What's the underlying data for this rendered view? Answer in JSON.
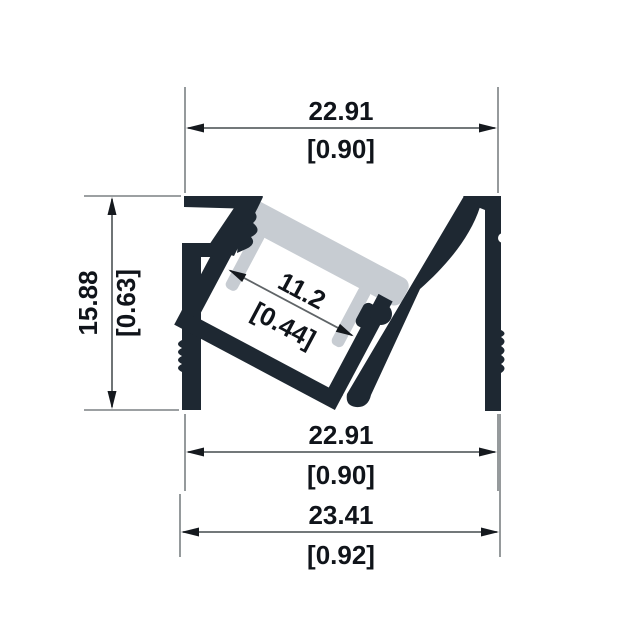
{
  "drawing": {
    "title": "LED aluminum profile cross-section",
    "type": "dimensioned technical drawing",
    "colors": {
      "profile_body": "#1e2832",
      "diffuser": "#c7ccd2",
      "dimension_lines": "#5f6467",
      "extension_lines": "#7b8084",
      "text": "#10141a",
      "background": "#ffffff"
    },
    "dimensions": {
      "top_width": {
        "mm": "22.91",
        "inch": "[0.90]"
      },
      "left_height": {
        "mm": "15.88",
        "inch": "[0.63]"
      },
      "inner_width": {
        "mm": "11.2",
        "inch": "[0.44]"
      },
      "bottom_inner": {
        "mm": "22.91",
        "inch": "[0.90]"
      },
      "bottom_overall": {
        "mm": "23.41",
        "inch": "[0.92]"
      }
    }
  }
}
